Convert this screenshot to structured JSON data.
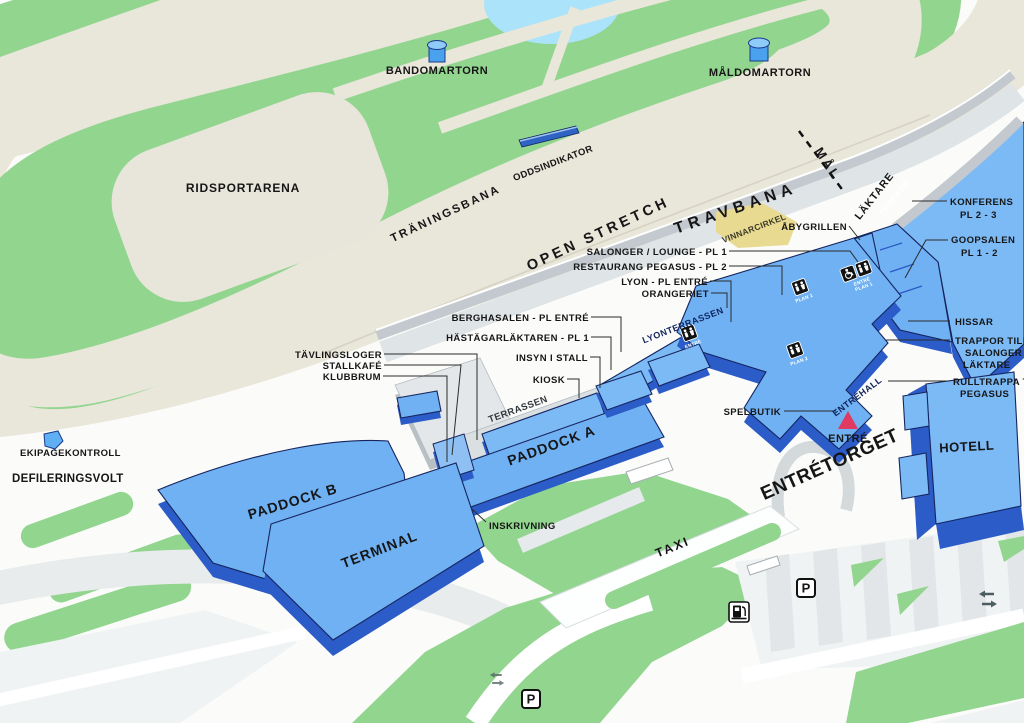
{
  "colors": {
    "bg": "#fbfcfa",
    "green": "#92d58f",
    "track": "#e9e6da",
    "pond": "#abe3fa",
    "blob": "#e8e6da",
    "bldg": "#6fb1f3",
    "bldg_light": "#7cbaf6",
    "bldg_dark": "#2b5cc8",
    "yellow": "#e9da92",
    "pink": "#e03a62",
    "parking": "#f0f3f4",
    "stripe": "#e2e6e8"
  },
  "labels": {
    "bandomartorn": "BANDOMARTORN",
    "maldomartorn": "MÅLDOMARTORN",
    "ridsportarena": "RIDSPORTARENA",
    "traningsbana": "TRÄNINGSBANA",
    "oddsindikator": "ODDSINDIKATOR",
    "open_stretch": "OPEN STRETCH",
    "travbana": "TRAVBANA",
    "mal": "MÅL",
    "laktare": "LÄKTARE",
    "terrass": "TERRASS",
    "konferens_1": "KONFERENS",
    "konferens_2": "PL 2 - 3",
    "goopsalen_1": "GOOPSALEN",
    "goopsalen_2": "PL 1 - 2",
    "abygrillen": "ÅBYGRILLEN",
    "vinnarcirkel": "VINNARCIRKEL",
    "salonger": "SALONGER / LOUNGE - PL 1",
    "restaurang": "RESTAURANG PEGASUS - PL 2",
    "lyon": "LYON - PL ENTRÉ",
    "orangeriet": "ORANGERIET",
    "berghasalen": "BERGHASALEN - PL ENTRÉ",
    "hastagarlaktaren": "HÄSTÄGARLÄKTAREN - PL 1",
    "insyn": "INSYN I STALL",
    "kiosk": "KIOSK",
    "tavlingsloger": "TÄVLINGSLOGER",
    "stallkafe": "STALLKAFÉ",
    "klubbrum": "KLUBBRUM",
    "terrassen": "TERRASSEN",
    "paddock_a": "PADDOCK A",
    "lyonterrassen": "LYONTERRASSEN",
    "hissar": "HISSAR",
    "trappor_1": "TRAPPOR TILL",
    "trappor_2": "SALONGER",
    "trappor_3": "LÄKTARE",
    "rulltrappa_1": "RULLTRAPPA TILL",
    "rulltrappa_2": "PEGASUS",
    "entrehall": "ENTRÉHALL",
    "spelbutik": "SPELBUTIK",
    "entre": "ENTRÉ",
    "entretorget": "ENTRÉTORGET",
    "hotell": "HOTELL",
    "ekipagekontroll": "EKIPAGEKONTROLL",
    "defileringsvolt": "DEFILERINGSVOLT",
    "paddock_b": "PADDOCK B",
    "terminal": "TERMINAL",
    "inskrivning": "INSKRIVNING",
    "taxi": "TAXI"
  },
  "icons": {
    "parking": "P",
    "plan1": "PLAN 1",
    "plan2": "PLAN 2",
    "entre": "ENTRÉ",
    "entre_plan1_line1": "ENTRÉ",
    "entre_plan1_line2": "PLAN 1"
  }
}
